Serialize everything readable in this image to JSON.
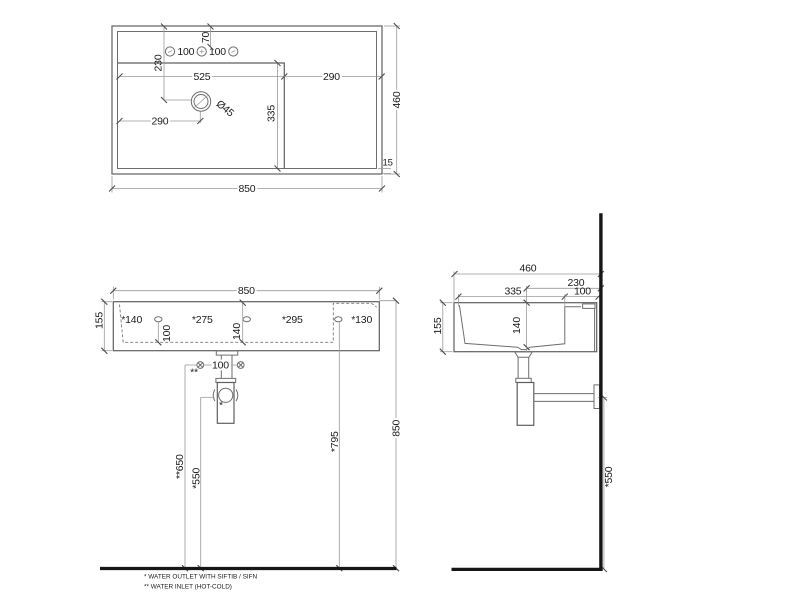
{
  "top_view": {
    "overall_width": "850",
    "overall_depth": "460",
    "tap_spacing_left": "100",
    "tap_spacing_right": "100",
    "tap_offset": "70",
    "drain_from_back": "230",
    "basin_width": "525",
    "deck_width": "290",
    "basin_depth": "335",
    "drain_from_left": "290",
    "drain_diameter": "Ø45",
    "front_edge": "15"
  },
  "front_view": {
    "overall_width": "850",
    "height": "155",
    "dim_140": "*140",
    "dim_275": "*275",
    "dim_295": "*295",
    "dim_130": "*130",
    "hole_drop": "100",
    "inner_height": "140",
    "inlet_spacing": "100",
    "inlet_mark": "**",
    "outlet_mark": "*",
    "inlet_height": "**650",
    "outlet_height": "*550",
    "hole_height": "*795",
    "rim_height": "850"
  },
  "side_view": {
    "overall_depth": "460",
    "drain_from_wall": "230",
    "basin_depth": "335",
    "deck_depth": "100",
    "height": "155",
    "inner_height": "140",
    "outlet_height": "*550"
  },
  "notes": {
    "outlet": "* WATER OUTLET WITH SIFTIB / SIFN",
    "inlet": "** WATER INLET  (HOT-COLD)"
  }
}
